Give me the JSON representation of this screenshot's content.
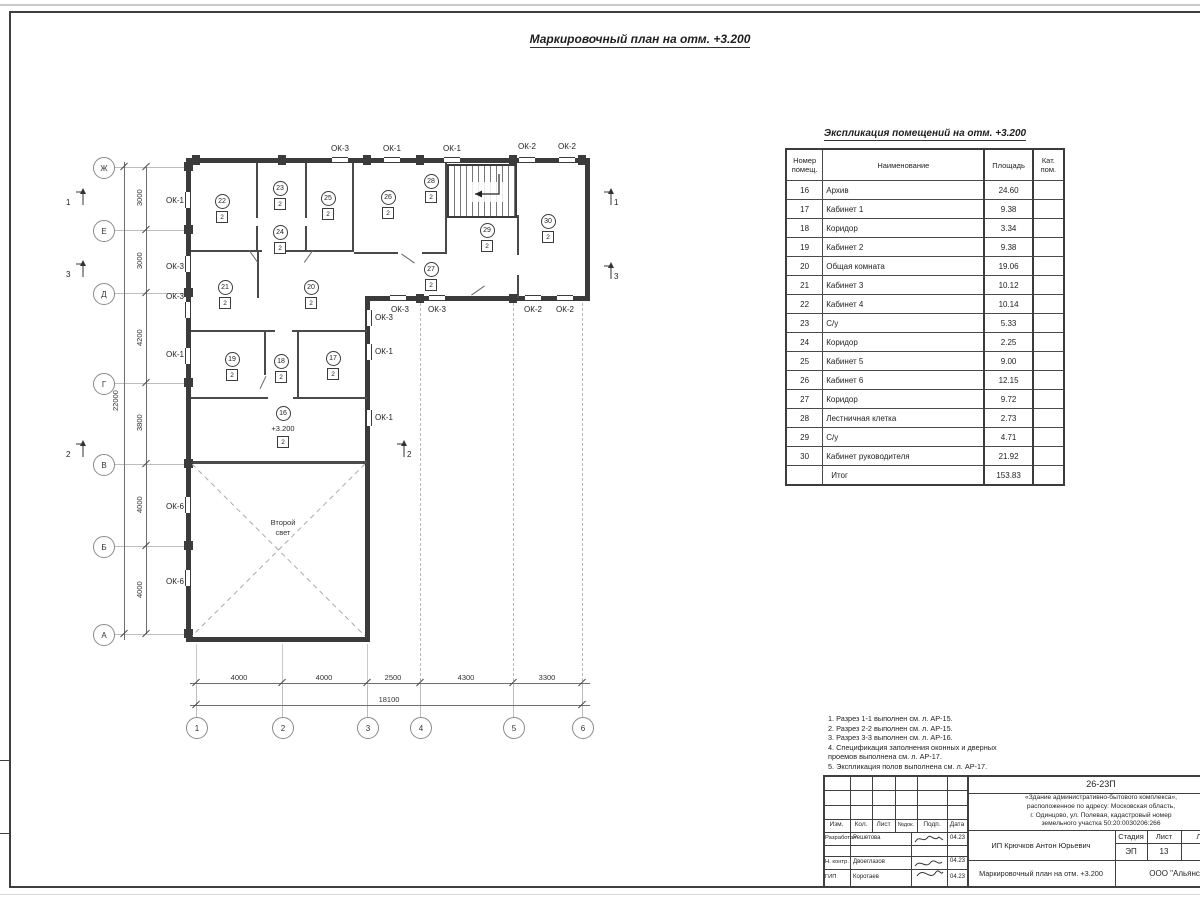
{
  "page": {
    "title": "Маркировочный план на отм. +3.200"
  },
  "plan": {
    "row_axes": [
      "Ж",
      "Е",
      "Д",
      "Г",
      "В",
      "Б",
      "А"
    ],
    "col_axes": [
      "1",
      "2",
      "3",
      "4",
      "5",
      "6"
    ],
    "v_dims": [
      "3000",
      "3000",
      "4200",
      "3800",
      "4000",
      "4000"
    ],
    "v_total": "22000",
    "h_dims": [
      "4000",
      "4000",
      "2500",
      "4300",
      "3300"
    ],
    "h_total": "18100",
    "sections": [
      "1",
      "2",
      "3"
    ],
    "cat": "2",
    "room16": "16",
    "level": "+3.200",
    "second_light": "Второй\nсвет",
    "rooms": [
      "22",
      "23",
      "24",
      "25",
      "26",
      "28",
      "29",
      "30",
      "27",
      "21",
      "20",
      "19",
      "18",
      "17"
    ],
    "windows": [
      "ОК-3",
      "ОК-1",
      "ОК-1",
      "ОК-2",
      "ОК-2",
      "ОК-1",
      "ОК-3",
      "ОК-3",
      "ОК-1",
      "ОК-6",
      "ОК-6",
      "ОК-3",
      "ОК-1",
      "ОК-1",
      "ОК-3",
      "ОК-3",
      "ОК-2",
      "ОК-2"
    ]
  },
  "schedule": {
    "title": "Экспликация помещений на отм. +3.200",
    "col_num": "Номер помещ.",
    "col_name": "Наименование",
    "col_area": "Площадь",
    "col_cat": "Кат. пом.",
    "rows": [
      {
        "num": "16",
        "name": "Архив",
        "area": "24.60",
        "cat": ""
      },
      {
        "num": "17",
        "name": "Кабинет 1",
        "area": "9.38",
        "cat": ""
      },
      {
        "num": "18",
        "name": "Коридор",
        "area": "3.34",
        "cat": ""
      },
      {
        "num": "19",
        "name": "Кабинет 2",
        "area": "9.38",
        "cat": ""
      },
      {
        "num": "20",
        "name": "Общая комната",
        "area": "19.06",
        "cat": ""
      },
      {
        "num": "21",
        "name": "Кабинет 3",
        "area": "10.12",
        "cat": ""
      },
      {
        "num": "22",
        "name": "Кабинет 4",
        "area": "10.14",
        "cat": ""
      },
      {
        "num": "23",
        "name": "С/у",
        "area": "5.33",
        "cat": ""
      },
      {
        "num": "24",
        "name": "Коридор",
        "area": "2.25",
        "cat": ""
      },
      {
        "num": "25",
        "name": "Кабинет 5",
        "area": "9.00",
        "cat": ""
      },
      {
        "num": "26",
        "name": "Кабинет 6",
        "area": "12.15",
        "cat": ""
      },
      {
        "num": "27",
        "name": "Коридор",
        "area": "9.72",
        "cat": ""
      },
      {
        "num": "28",
        "name": "Лестничная клетка",
        "area": "2.73",
        "cat": ""
      },
      {
        "num": "29",
        "name": "С/у",
        "area": "4.71",
        "cat": ""
      },
      {
        "num": "30",
        "name": "Кабинет руководителя",
        "area": "21.92",
        "cat": ""
      },
      {
        "num": "",
        "name": "Итог",
        "area": "153.83",
        "cat": ""
      }
    ]
  },
  "notes": {
    "lines": [
      "1. Разрез 1-1 выполнен см. л. АР-15.",
      "2. Разрез 2-2 выполнен см. л. АР-15.",
      "3. Разрез 3-3 выполнен см. л. АР-16.",
      "4. Спецификация заполнения оконных и дверных\n    проемов выполнена см. л. АР-17.",
      "5. Экспликация полов выполнена см. л. АР-17."
    ]
  },
  "stamp": {
    "code": "26-23П",
    "description": "«Здание административно-бытового комплекса»,\nрасположенное по адресу: Московская область,\nг. Одинцово, ул. Полевая, кадастровый номер\nземельного участка 50:20:0030206:266",
    "cols": [
      "Изм.",
      "Кол.",
      "Лист",
      "№док.",
      "Подп.",
      "Дата"
    ],
    "row1_role": "Разработал",
    "row1_name": "Решетова",
    "row1_date": "04.23",
    "row2_role": "Н. контр.",
    "row2_name": "Двоеглазов",
    "row2_date": "04.23",
    "row3_role": "ГИП",
    "row3_name": "Коротаев",
    "row3_date": "04.23",
    "client": "ИП Крючков Антон Юрьевич",
    "stage_label": "Стадия",
    "sheet_label": "Лист",
    "sheets_label": "Листов",
    "stage": "ЭП",
    "sheet": "13",
    "sheets": "17",
    "doc_title": "Маркировочный план на отм. +3.200",
    "org": "ООО \"Альянс\""
  }
}
